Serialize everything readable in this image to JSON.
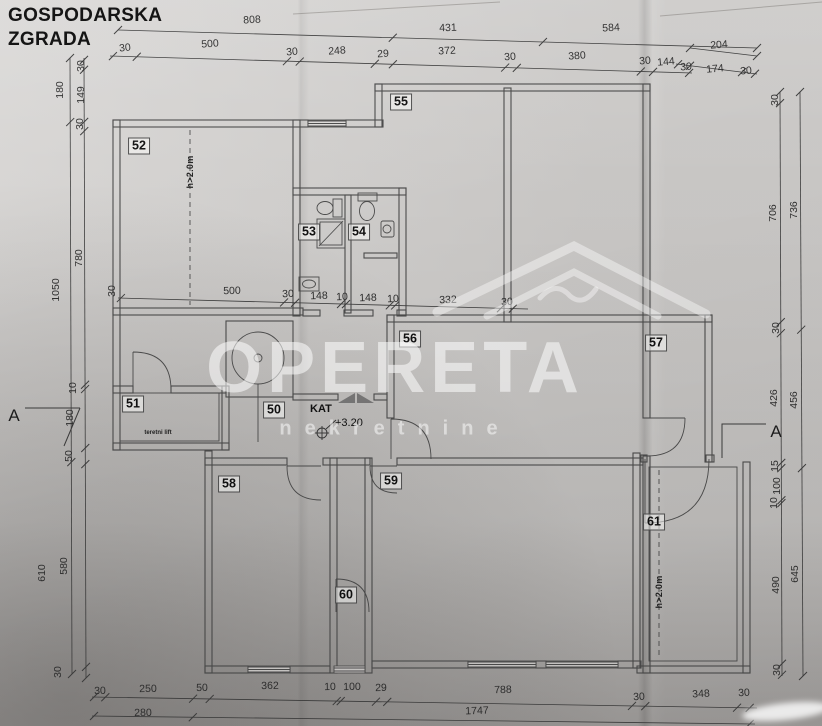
{
  "title": {
    "line1": "GOSPODARSKA",
    "line2": "ZGRADA"
  },
  "watermark": {
    "line1": "OPERETA",
    "line2": "nekretnine"
  },
  "level": {
    "label": "KAT",
    "value": "+3.20"
  },
  "colors": {
    "paper": "#d2d0ce",
    "ink": "#4a4a4a",
    "watermark": "rgba(255,255,255,0.55)"
  },
  "section_marks": [
    {
      "t": "A",
      "x": 14,
      "y": 416
    },
    {
      "t": "A",
      "x": 776,
      "y": 432
    }
  ],
  "rooms": [
    {
      "n": "52",
      "x": 139,
      "y": 146
    },
    {
      "n": "53",
      "x": 309,
      "y": 232
    },
    {
      "n": "54",
      "x": 359,
      "y": 232
    },
    {
      "n": "55",
      "x": 401,
      "y": 102
    },
    {
      "n": "56",
      "x": 410,
      "y": 339
    },
    {
      "n": "57",
      "x": 656,
      "y": 343
    },
    {
      "n": "50",
      "x": 274,
      "y": 410
    },
    {
      "n": "51",
      "x": 133,
      "y": 404
    },
    {
      "n": "58",
      "x": 229,
      "y": 484
    },
    {
      "n": "59",
      "x": 391,
      "y": 481
    },
    {
      "n": "60",
      "x": 346,
      "y": 595
    },
    {
      "n": "61",
      "x": 654,
      "y": 522
    }
  ],
  "notes": [
    {
      "t": "h>2.0m",
      "x": 190,
      "y": 172,
      "tiny": false
    },
    {
      "t": "h>2.0m",
      "x": 659,
      "y": 592,
      "tiny": false
    },
    {
      "t": "teretni lift",
      "x": 158,
      "y": 433,
      "tiny": true
    }
  ],
  "dims": [
    {
      "t": "808",
      "x": 252,
      "y": 20,
      "r": -3
    },
    {
      "t": "431",
      "x": 448,
      "y": 28,
      "r": -2
    },
    {
      "t": "584",
      "x": 611,
      "y": 28,
      "r": -3
    },
    {
      "t": "30",
      "x": 125,
      "y": 48,
      "r": -6
    },
    {
      "t": "500",
      "x": 210,
      "y": 44,
      "r": -4
    },
    {
      "t": "30",
      "x": 292,
      "y": 52,
      "r": -5
    },
    {
      "t": "248",
      "x": 337,
      "y": 51,
      "r": -4
    },
    {
      "t": "29",
      "x": 383,
      "y": 54,
      "r": -4
    },
    {
      "t": "372",
      "x": 447,
      "y": 51,
      "r": -3
    },
    {
      "t": "30",
      "x": 510,
      "y": 57,
      "r": -4
    },
    {
      "t": "380",
      "x": 577,
      "y": 56,
      "r": -4
    },
    {
      "t": "30",
      "x": 645,
      "y": 61,
      "r": -5
    },
    {
      "t": "144",
      "x": 666,
      "y": 62,
      "r": -5
    },
    {
      "t": "204",
      "x": 719,
      "y": 45,
      "r": -4
    },
    {
      "t": "30",
      "x": 686,
      "y": 67,
      "r": -5
    },
    {
      "t": "174",
      "x": 715,
      "y": 69,
      "r": -5
    },
    {
      "t": "30",
      "x": 746,
      "y": 71,
      "r": -5
    },
    {
      "t": "180",
      "x": 60,
      "y": 90,
      "r": -90
    },
    {
      "t": "30",
      "x": 81,
      "y": 66,
      "r": -90
    },
    {
      "t": "149",
      "x": 81,
      "y": 95,
      "r": -90
    },
    {
      "t": "30",
      "x": 80,
      "y": 124,
      "r": -90
    },
    {
      "t": "1050",
      "x": 56,
      "y": 290,
      "r": -90
    },
    {
      "t": "780",
      "x": 79,
      "y": 258,
      "r": -90
    },
    {
      "t": "10",
      "x": 73,
      "y": 388,
      "r": -90
    },
    {
      "t": "180",
      "x": 70,
      "y": 418,
      "r": -90
    },
    {
      "t": "50",
      "x": 69,
      "y": 456,
      "r": -90
    },
    {
      "t": "610",
      "x": 42,
      "y": 573,
      "r": -90
    },
    {
      "t": "580",
      "x": 64,
      "y": 566,
      "r": -90
    },
    {
      "t": "30",
      "x": 58,
      "y": 672,
      "r": -90
    },
    {
      "t": "30",
      "x": 112,
      "y": 291,
      "r": -90
    },
    {
      "t": "500",
      "x": 232,
      "y": 291,
      "r": -2
    },
    {
      "t": "30",
      "x": 288,
      "y": 294,
      "r": -2
    },
    {
      "t": "148",
      "x": 319,
      "y": 296,
      "r": -2
    },
    {
      "t": "10",
      "x": 342,
      "y": 297,
      "r": -2
    },
    {
      "t": "148",
      "x": 368,
      "y": 298,
      "r": -2
    },
    {
      "t": "10",
      "x": 393,
      "y": 299,
      "r": -2
    },
    {
      "t": "332",
      "x": 448,
      "y": 300,
      "r": -2
    },
    {
      "t": "30",
      "x": 507,
      "y": 302,
      "r": -2
    },
    {
      "t": "30",
      "x": 775,
      "y": 100,
      "r": -90
    },
    {
      "t": "706",
      "x": 773,
      "y": 213,
      "r": -90
    },
    {
      "t": "736",
      "x": 794,
      "y": 210,
      "r": -90
    },
    {
      "t": "30",
      "x": 776,
      "y": 328,
      "r": -90
    },
    {
      "t": "426",
      "x": 774,
      "y": 398,
      "r": -90
    },
    {
      "t": "456",
      "x": 794,
      "y": 400,
      "r": -90
    },
    {
      "t": "15",
      "x": 775,
      "y": 466,
      "r": -90
    },
    {
      "t": "100",
      "x": 777,
      "y": 486,
      "r": -90
    },
    {
      "t": "10",
      "x": 774,
      "y": 503,
      "r": -90
    },
    {
      "t": "490",
      "x": 776,
      "y": 585,
      "r": -90
    },
    {
      "t": "645",
      "x": 795,
      "y": 574,
      "r": -90
    },
    {
      "t": "30",
      "x": 777,
      "y": 670,
      "r": -90
    },
    {
      "t": "30",
      "x": 100,
      "y": 691,
      "r": -1
    },
    {
      "t": "250",
      "x": 148,
      "y": 689,
      "r": -1
    },
    {
      "t": "50",
      "x": 202,
      "y": 688,
      "r": -1
    },
    {
      "t": "362",
      "x": 270,
      "y": 686,
      "r": -1
    },
    {
      "t": "10",
      "x": 330,
      "y": 687,
      "r": -1
    },
    {
      "t": "100",
      "x": 352,
      "y": 687,
      "r": -1
    },
    {
      "t": "29",
      "x": 381,
      "y": 688,
      "r": -1
    },
    {
      "t": "788",
      "x": 503,
      "y": 690,
      "r": -2
    },
    {
      "t": "30",
      "x": 639,
      "y": 697,
      "r": -3
    },
    {
      "t": "348",
      "x": 701,
      "y": 694,
      "r": -3
    },
    {
      "t": "30",
      "x": 744,
      "y": 693,
      "r": -3
    },
    {
      "t": "280",
      "x": 143,
      "y": 713,
      "r": -1
    },
    {
      "t": "1747",
      "x": 477,
      "y": 711,
      "r": -2
    }
  ]
}
